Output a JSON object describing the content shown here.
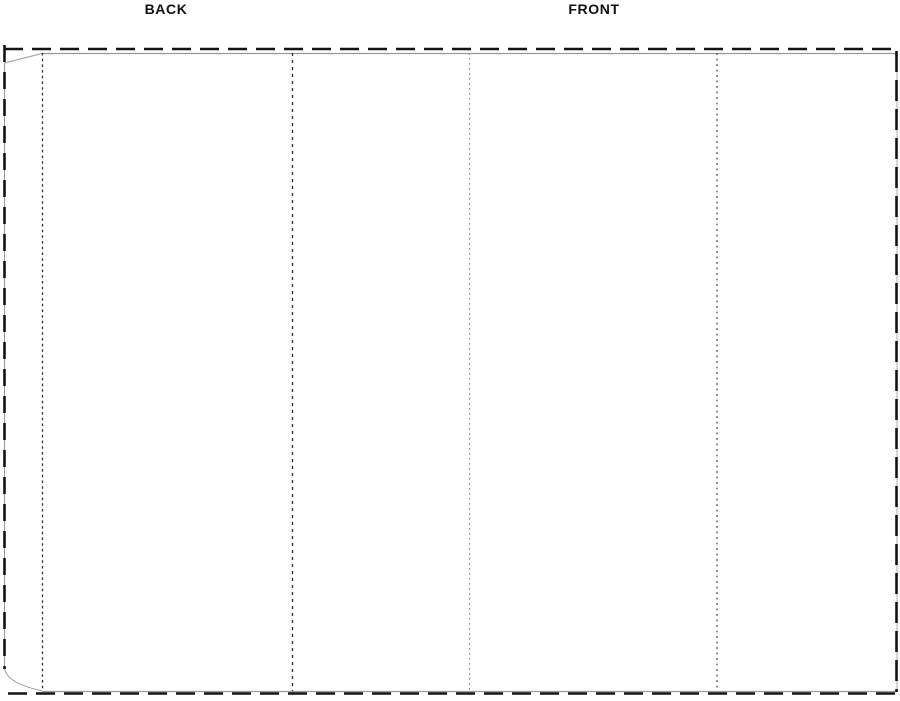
{
  "labels": {
    "back": "BACK",
    "front": "FRONT"
  },
  "colors": {
    "background": "#ffffff",
    "cut_line": "#141414",
    "die_line": "#999999",
    "fold_dark": "#2e2e2e",
    "fold_medium": "#4a4a4a",
    "fold_light": "#8f8f8f",
    "label_text": "#111111"
  }
}
